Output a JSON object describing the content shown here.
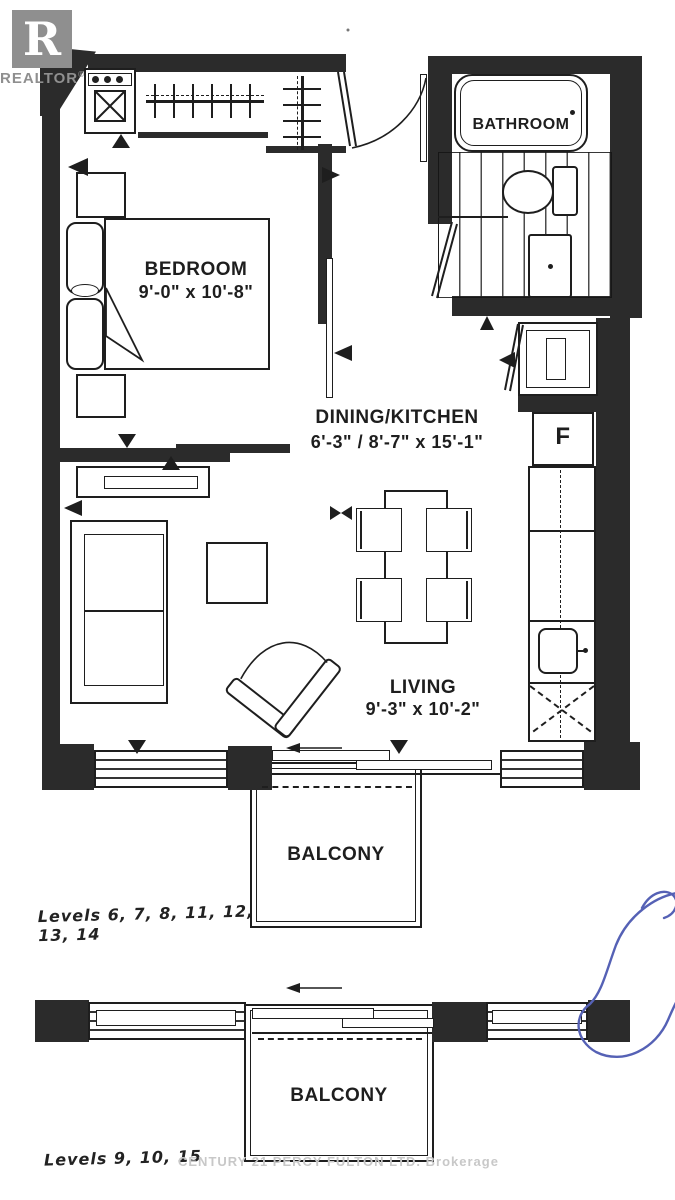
{
  "logo": {
    "letter": "R",
    "brand": "REALTOR",
    "registered_mark": "®"
  },
  "rooms": {
    "bathroom": {
      "label": "BATHROOM"
    },
    "bedroom": {
      "label": "BEDROOM",
      "dimensions": "9'-0\" x 10'-8\""
    },
    "dining_kitchen": {
      "label": "DINING/KITCHEN",
      "dimensions": "6'-3\" / 8'-7\" x 15'-1\""
    },
    "living": {
      "label": "LIVING",
      "dimensions": "9'-3\" x 10'-2\""
    },
    "balcony_upper": {
      "label": "BALCONY"
    },
    "balcony_lower": {
      "label": "BALCONY"
    }
  },
  "kitchen": {
    "fridge_label": "F"
  },
  "annotations": {
    "levels_plan_a": "Levels 6, 7, 8, 11, 12, 13, 14",
    "levels_plan_b": "Levels 9, 10, 15",
    "watermark": "CENTURY 21 PERCY FULTON LTD. Brokerage"
  },
  "colors": {
    "ink": "#1e1e1e",
    "wall": "#2b2b2b",
    "logo_gray": "#8f8f8f",
    "watermark_gray": "#c8c8c8",
    "pen_blue": "#5561b5",
    "paper": "#ffffff"
  }
}
